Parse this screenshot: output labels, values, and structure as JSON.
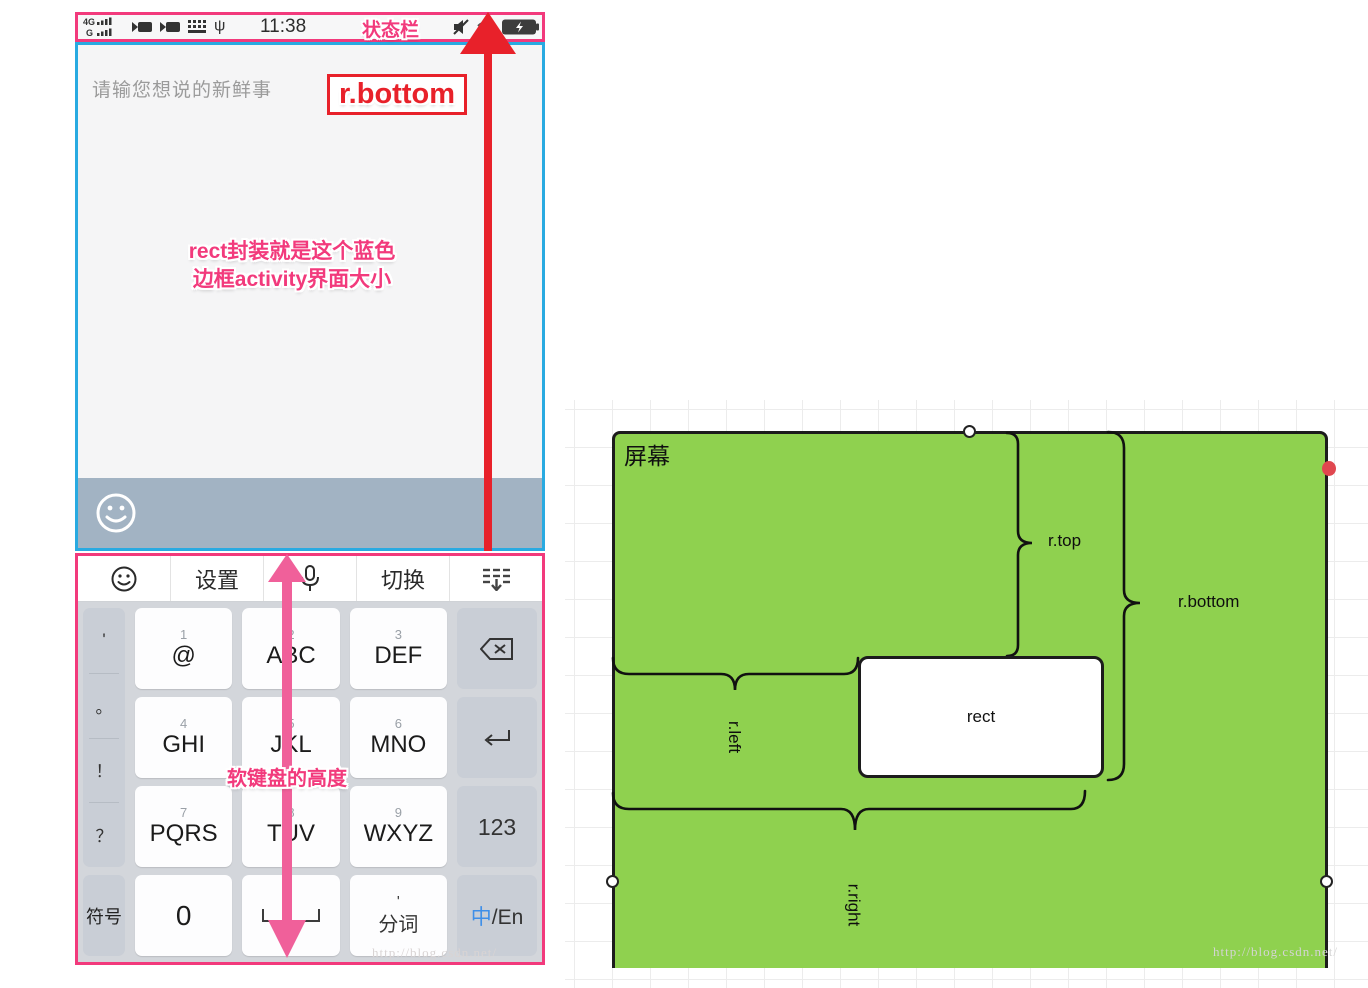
{
  "colors": {
    "pink": "#f23a7c",
    "blue": "#29aae1",
    "red": "#e8212a",
    "arrow_pink": "#f0609a",
    "green": "#8fd14f",
    "toolbar_band": "#a2b3c3",
    "key_gray": "#c9ced6",
    "lang_blue": "#3f8fe8",
    "handle_red": "#e0474f"
  },
  "phone": {
    "status_bar": {
      "time": "11:38",
      "label": "状态栏",
      "icons": {
        "left": [
          "signal-4g",
          "video-camera",
          "video-camera",
          "keyboard",
          "usb"
        ],
        "right": [
          "mute",
          "wifi",
          "battery-charging"
        ]
      }
    },
    "editor": {
      "placeholder": "请输您想说的新鲜事"
    },
    "annotations": {
      "r_bottom": "r.bottom",
      "note_line1": "rect封装就是这个蓝色",
      "note_line2": "边框activity界面大小",
      "keyboard_height": "软键盘的高度"
    },
    "keyboard": {
      "toolbar": {
        "settings": "设置",
        "switch": "切换"
      },
      "punct": [
        "'",
        "。",
        "！",
        "？"
      ],
      "symbol_key": "符号",
      "keys": [
        {
          "num": "1",
          "label": "@"
        },
        {
          "num": "2",
          "label": "ABC"
        },
        {
          "num": "3",
          "label": "DEF"
        },
        {
          "num": "4",
          "label": "GHI"
        },
        {
          "num": "5",
          "label": "JKL"
        },
        {
          "num": "6",
          "label": "MNO"
        },
        {
          "num": "7",
          "label": "PQRS"
        },
        {
          "num": "8",
          "label": "TUV"
        },
        {
          "num": "9",
          "label": "WXYZ"
        }
      ],
      "zero_key": "0",
      "word_key_mark": "'",
      "word_key": "分词",
      "numbers_key": "123",
      "lang_key": {
        "zh": "中",
        "sep": "/",
        "en": "En"
      }
    },
    "watermark": "http://blog.csdn.net/"
  },
  "diagram": {
    "screen_label": "屏幕",
    "rect_label": "rect",
    "braces": {
      "top": "r.top",
      "bottom": "r.bottom",
      "left": "r.left",
      "right": "r.right"
    },
    "watermark": "http://blog.csdn.net/"
  }
}
